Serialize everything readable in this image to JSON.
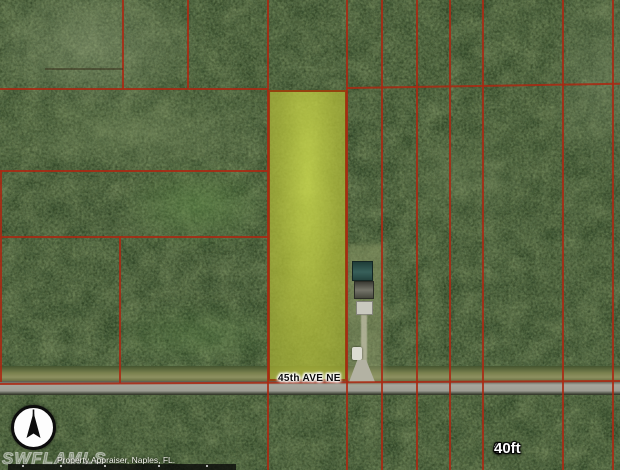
{
  "map": {
    "road_label": "45th AVE NE",
    "scale_bar": {
      "start": "0",
      "end": "40ft"
    },
    "watermark": "SWFLAMLS",
    "attribution": "Property Appraiser, Naples, FL.",
    "colors": {
      "parcel_line": "#ac2812",
      "highlight_fill": "#b7c24a",
      "highlight_border": "#943e0e",
      "road_pavement": "#a7a79d",
      "forest_base": "#3a5130"
    }
  }
}
